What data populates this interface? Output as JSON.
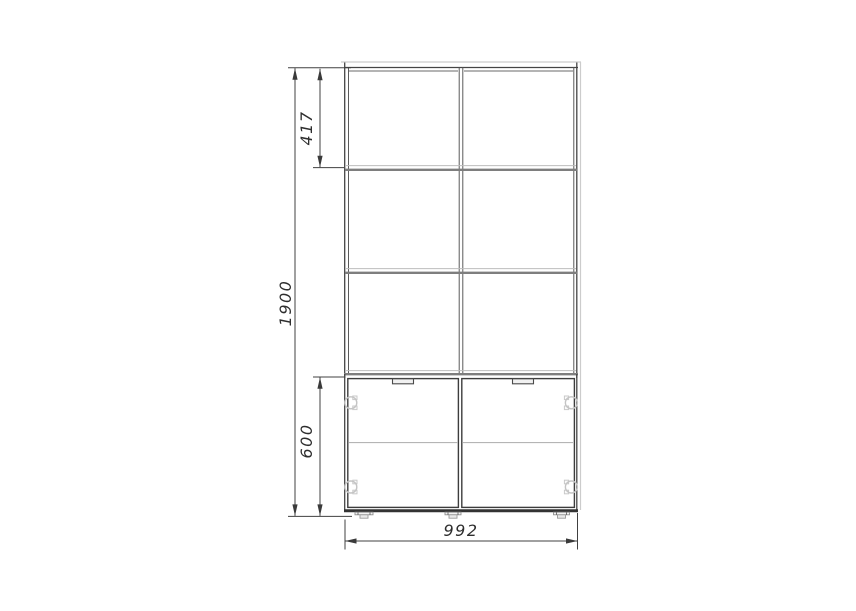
{
  "drawing": {
    "kind": "furniture-front-view-technical-drawing",
    "object": "shelf-unit-with-lower-two-door-cabinet",
    "dimensions": {
      "total_height": "1900",
      "top_shelf_section_height": "417",
      "lower_cabinet_height": "600",
      "overall_width": "992"
    },
    "structure": {
      "shelf_columns": 2,
      "open_shelf_rows": 3,
      "cabinet_doors": 2,
      "door_handles": 2,
      "door_hinges": 4,
      "feet": 3,
      "internal_cabinet_shelves": 1
    },
    "colors": {
      "background": "#ffffff",
      "main_outline": "#454545",
      "door_outline": "#3d3d3d",
      "shelf_edge": "#7e7e7e",
      "light_edge": "#cccccc",
      "hinge": "#c4c4c4",
      "dimension_line": "#404040",
      "dimension_text": "#2e2e2e"
    }
  }
}
